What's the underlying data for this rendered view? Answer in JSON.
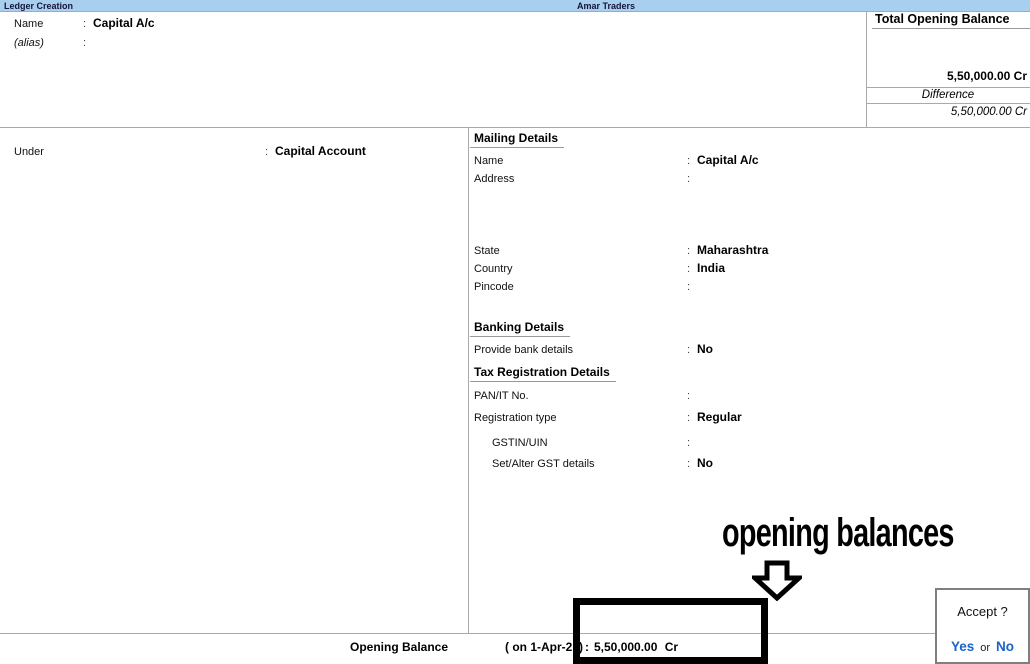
{
  "colors": {
    "titlebar_bg": "#a9cfee",
    "titlebar_text": "#14143c",
    "accent_blue": "#1b63c8",
    "line_gray": "#aaaaaa",
    "annotation_black": "#000000"
  },
  "ui": {
    "colon": ":"
  },
  "titlebar": {
    "screen_title": "Ledger Creation",
    "company_name": "Amar Traders"
  },
  "name_section": {
    "name_label": "Name",
    "name_value": "Capital A/c",
    "alias_label": "(alias)",
    "alias_value": ""
  },
  "totals_panel": {
    "heading": "Total Opening Balance",
    "total_value": "5,50,000.00 Cr",
    "difference_label": "Difference",
    "difference_value": "5,50,000.00 Cr"
  },
  "ledger_form": {
    "under_label": "Under",
    "under_value": "Capital Account"
  },
  "mailing_details": {
    "heading": "Mailing Details",
    "rows": [
      {
        "label": "Name",
        "value": "Capital A/c"
      },
      {
        "label": "Address",
        "value": ""
      },
      {
        "label": "State",
        "value": "Maharashtra"
      },
      {
        "label": "Country",
        "value": "India"
      },
      {
        "label": "Pincode",
        "value": ""
      }
    ]
  },
  "banking_details": {
    "heading": "Banking Details",
    "rows": [
      {
        "label": "Provide bank details",
        "value": "No"
      }
    ]
  },
  "tax_details": {
    "heading": "Tax Registration Details",
    "rows": [
      {
        "label": "PAN/IT No.",
        "value": ""
      },
      {
        "label": "Registration type",
        "value": "Regular"
      },
      {
        "label": "GSTIN/UIN",
        "value": ""
      },
      {
        "label": "Set/Alter GST details",
        "value": "No"
      }
    ]
  },
  "opening_balance_bar": {
    "label": "Opening Balance",
    "date": "( on 1-Apr-21)",
    "amount": "5,50,000.00 Cr"
  },
  "annotation": {
    "text": "opening balances"
  },
  "accept_dialog": {
    "title": "Accept ?",
    "yes": "Yes",
    "or": "or",
    "no": "No"
  }
}
